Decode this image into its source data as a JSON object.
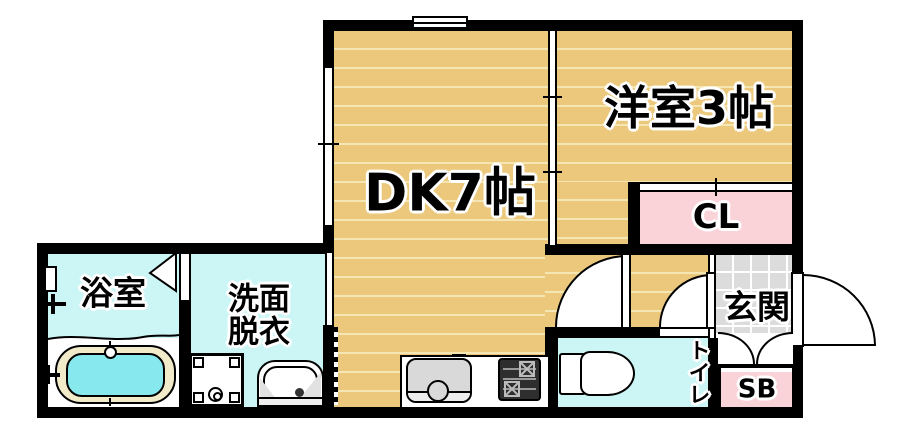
{
  "title": "apartment-floor-plan",
  "rooms": {
    "dk": "DK7帖",
    "western_room": "洋室3帖",
    "closet": "CL",
    "bathroom": "浴室",
    "washroom_line1": "洗面",
    "washroom_line2": "脱衣",
    "toilet": "トイレ",
    "entrance": "玄関",
    "shoe_box": "SB"
  },
  "colors": {
    "wall": "#000000",
    "floor-tan": "#EBC87B",
    "floor-stripe": "#F5E7B4",
    "room-cyan": "#CCF5F5",
    "tub-water": "#87E9ED",
    "tub-rim": "#F2EBC9",
    "closet-pink": "#FAD3D8",
    "tile-gray": "#DCDCDC",
    "fixture-gray": "#D9D9D9"
  }
}
